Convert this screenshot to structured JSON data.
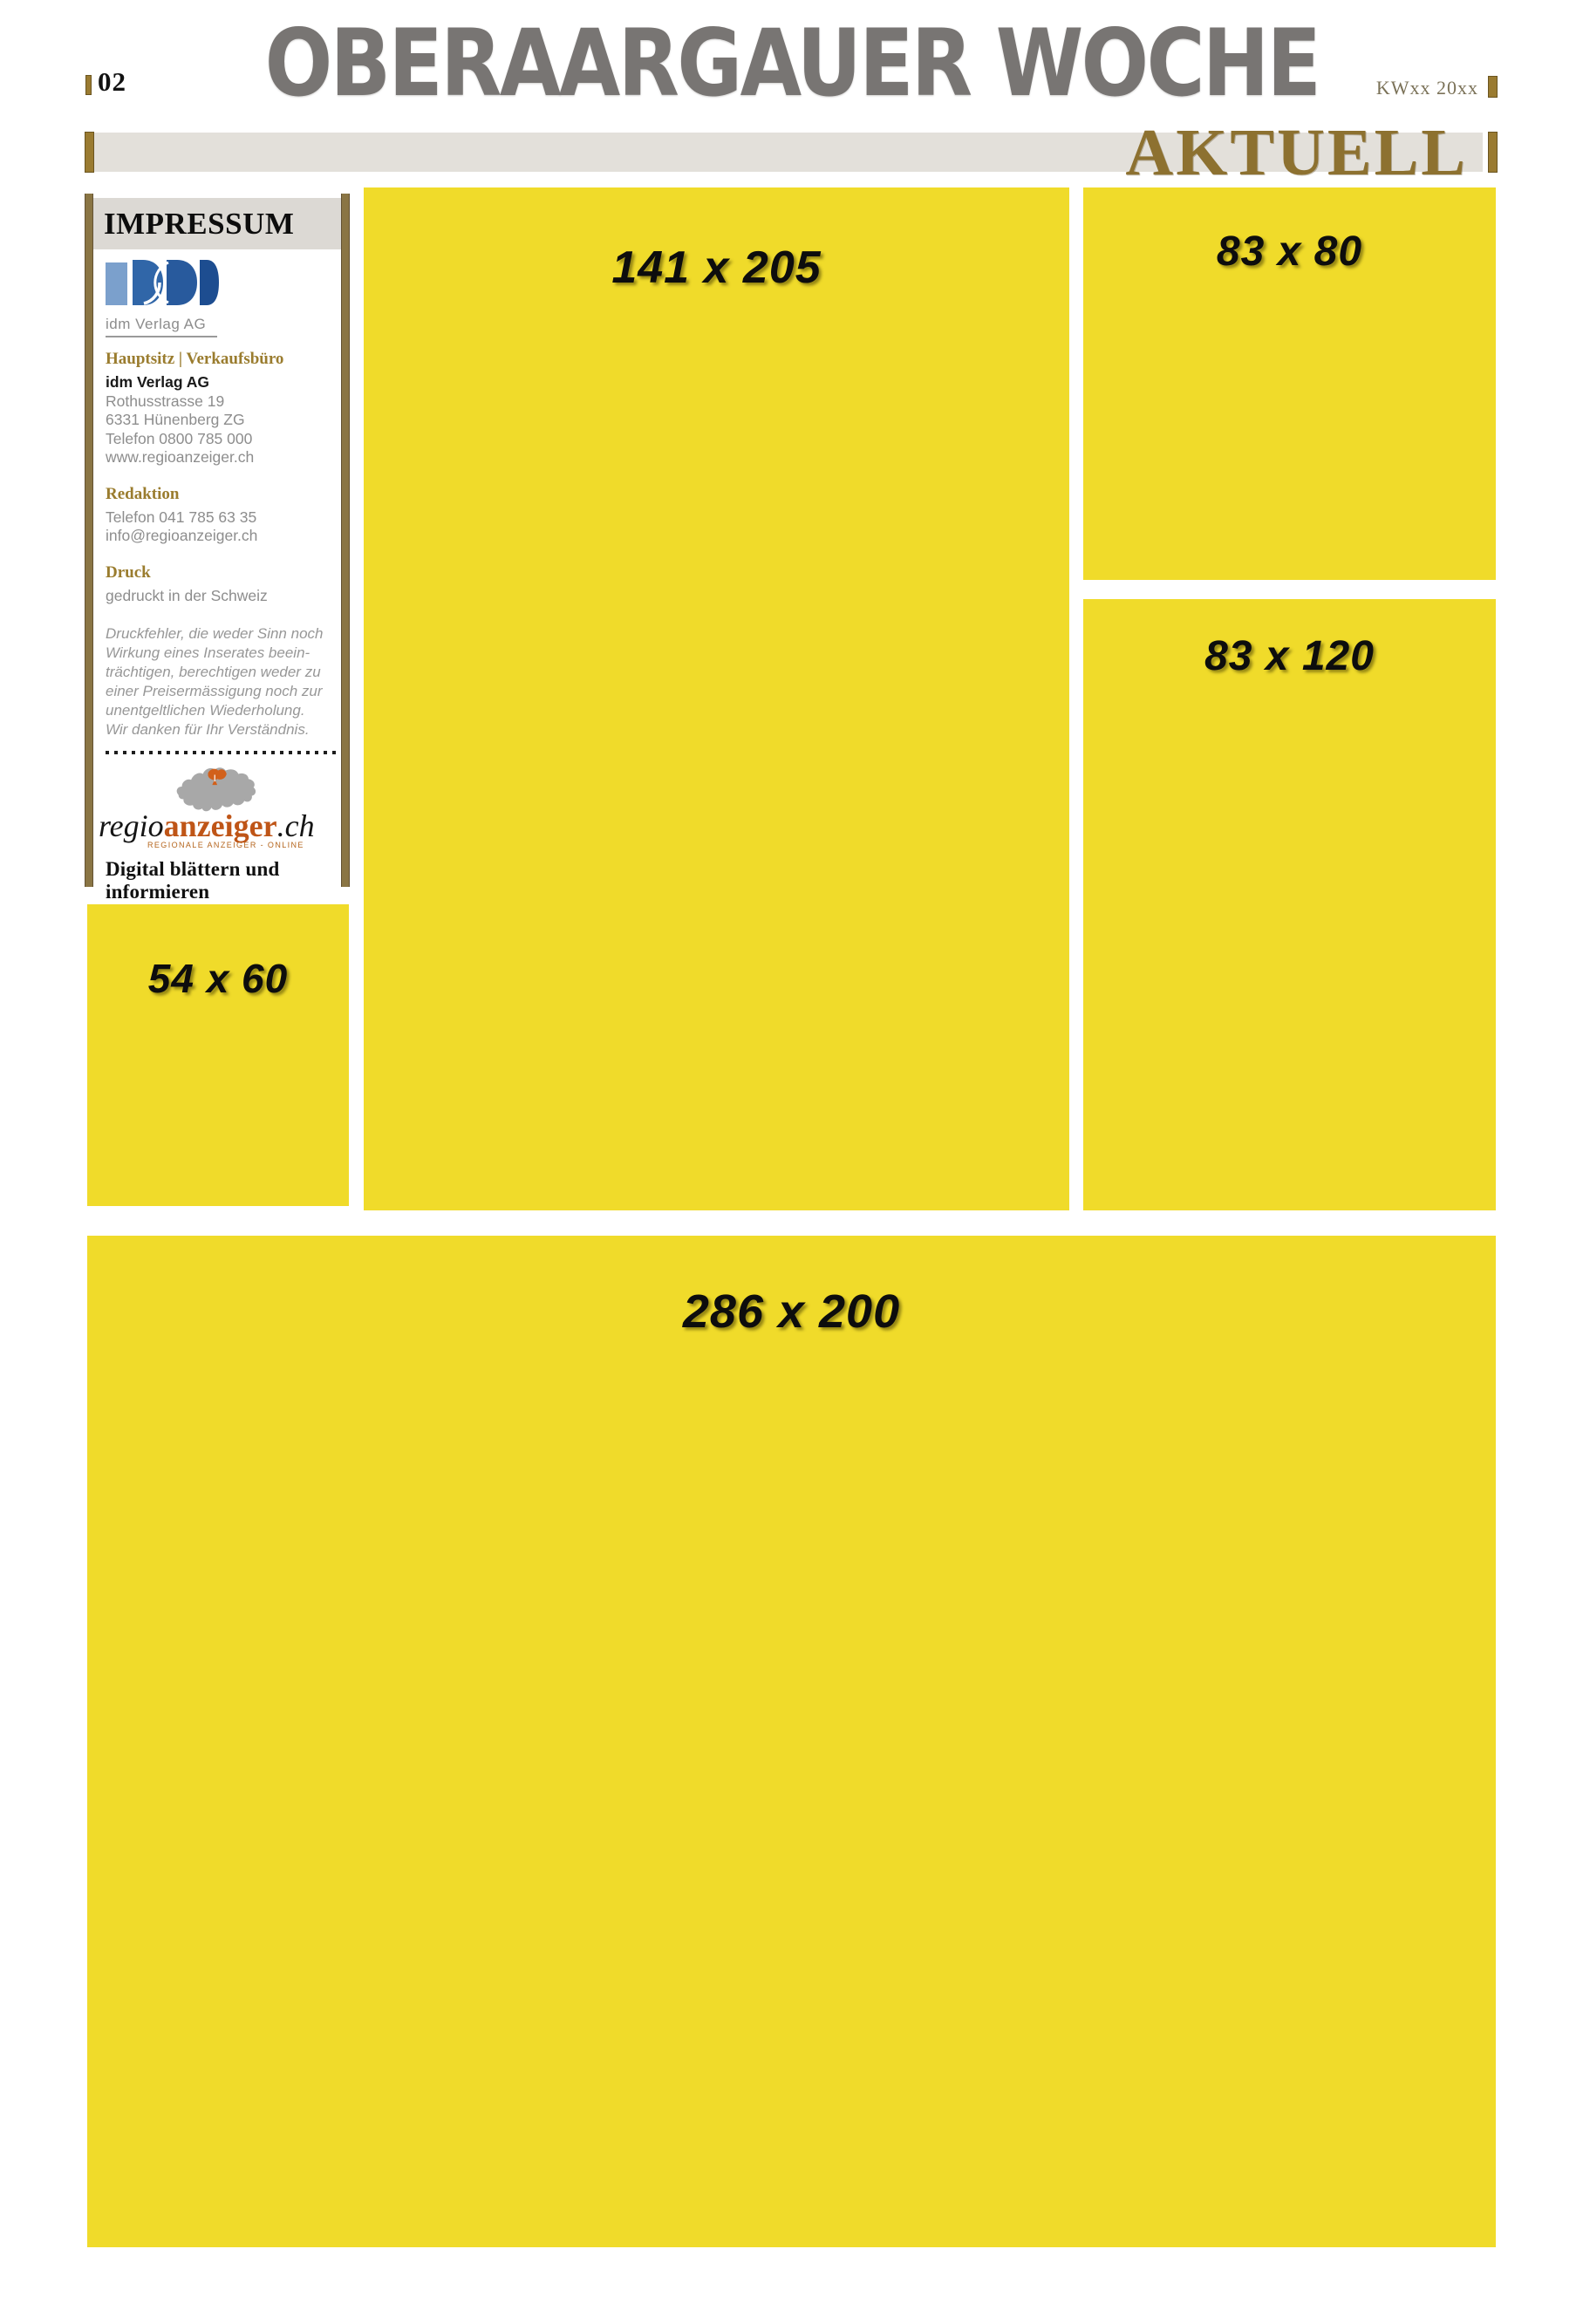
{
  "header": {
    "page_number": "02",
    "masthead": "OBERAARGAUER WOCHE",
    "issue_code": "KWxx 20xx",
    "section_label": "AKTUELL"
  },
  "impressum": {
    "title": "IMPRESSUM",
    "publisher_caption": "idm Verlag AG",
    "sections": [
      {
        "heading": "Hauptsitz | Verkaufsbüro",
        "company": "idm Verlag AG",
        "lines": [
          "Rothusstrasse 19",
          "6331 Hünenberg ZG",
          "Telefon 0800 785 000",
          "www.regioanzeiger.ch"
        ]
      },
      {
        "heading": "Redaktion",
        "lines": [
          "Telefon 041 785 63 35",
          "info@regioanzeiger.ch"
        ]
      },
      {
        "heading": "Druck",
        "lines": [
          "gedruckt in der Schweiz"
        ]
      }
    ],
    "disclaimer_lines": [
      "Druckfehler, die weder Sinn noch",
      "Wirkung eines Inserates beein-",
      "trächtigen, berechtigen weder zu",
      "einer Preisermässigung noch zur",
      "unentgeltlichen Wiederholung.",
      "Wir danken für Ihr Verständnis."
    ],
    "brand": {
      "regio": "regio",
      "anzeiger": "anzeiger",
      "tld": ".ch",
      "tagline": "REGIONALE ANZEIGER - ONLINE"
    },
    "cta_lines": [
      "Digital blättern und",
      "informieren"
    ]
  },
  "ad_slots": [
    {
      "label": "141 x 205"
    },
    {
      "label": "83 x 80"
    },
    {
      "label": "83 x 120"
    },
    {
      "label": "54 x 60"
    },
    {
      "label": "286 x 200"
    }
  ],
  "colors": {
    "slot_yellow": "#f0db2a",
    "gold": "#9a7b31",
    "gold_dark": "#6b5520",
    "section_band": "#e3e0da",
    "aktuell_text": "#8d7130",
    "masthead_gray": "#787573",
    "impressum_gold": "#9a7c2e",
    "brand_orange": "#bf5517",
    "map_gray": "#a8a8a8",
    "map_orange": "#d2601a",
    "logo_blue_light": "#7ba0cc",
    "logo_blue_dark": "#1d4d90"
  }
}
